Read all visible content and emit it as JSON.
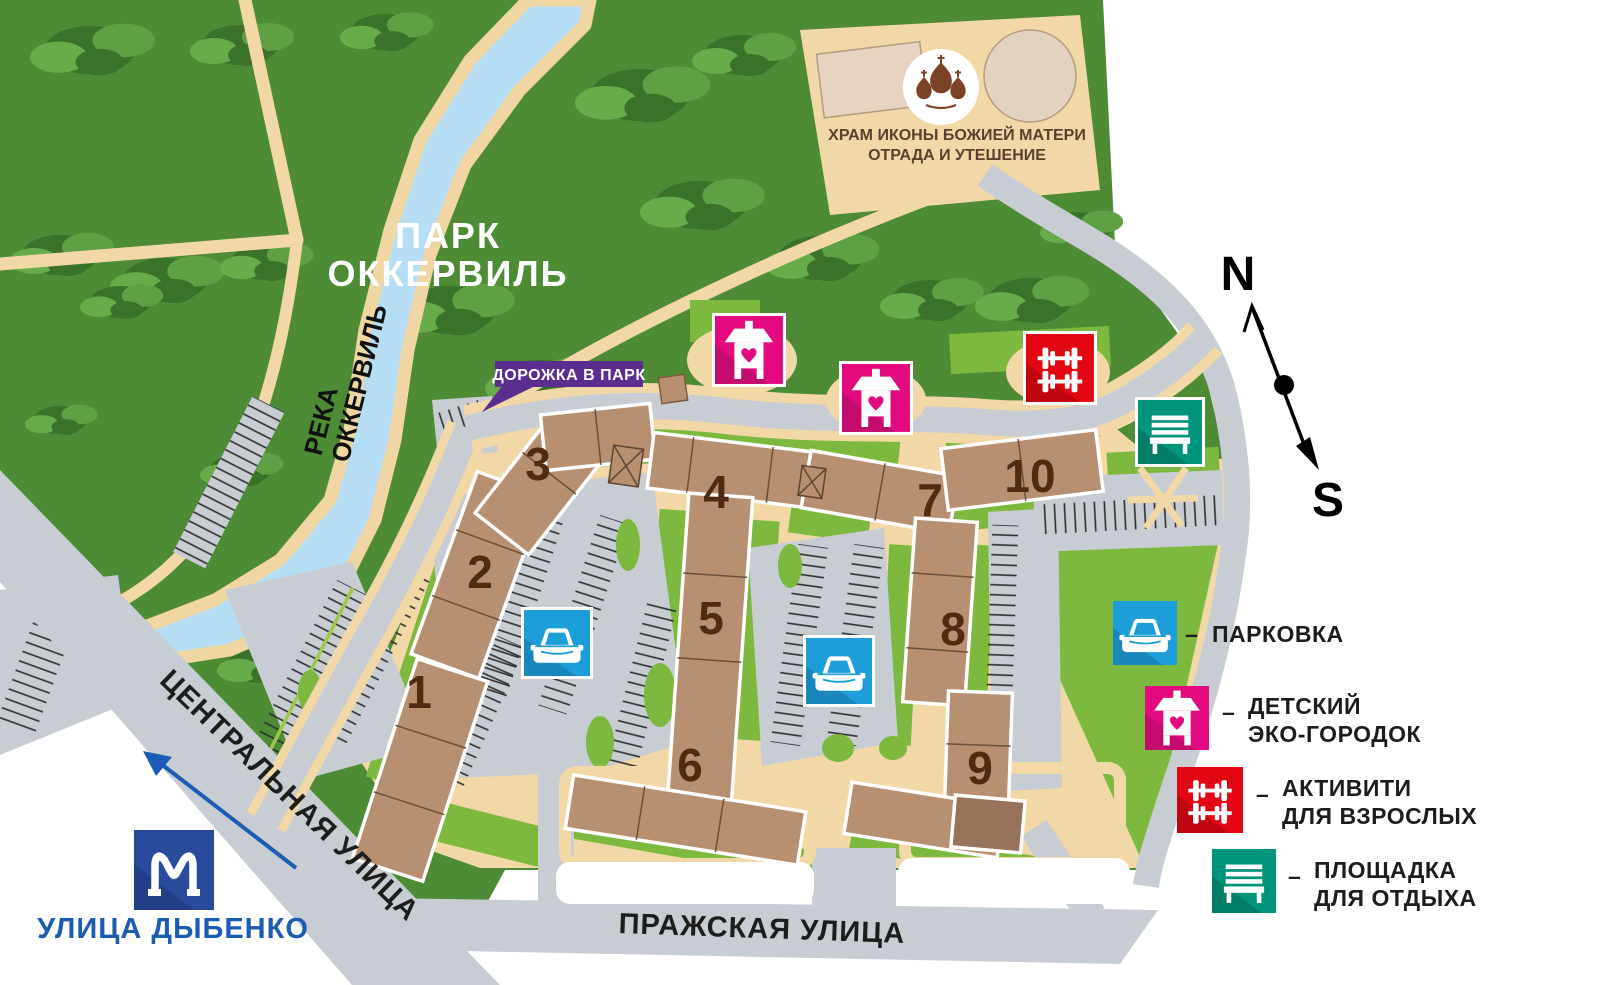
{
  "map": {
    "park_label": {
      "line1": "ПАРК",
      "line2": "ОККЕРВИЛЬ"
    },
    "river_label": {
      "line1": "РЕКА",
      "line2": "ОККЕРВИЛЬ"
    },
    "church_label": {
      "line1": "ХРАМ ИКОНЫ БОЖИЕЙ МАТЕРИ",
      "line2": "ОТРАДА И УТЕШЕНИЕ"
    },
    "path_to_park_badge": "ДОРОЖКА В ПАРК",
    "streets": {
      "central": "ЦЕНТРАЛЬНАЯ УЛИЦА",
      "prazhskaya": "ПРАЖСКАЯ УЛИЦА"
    },
    "metro_station": "УЛИЦА ДЫБЕНКО",
    "compass": {
      "north": "N",
      "south": "S"
    },
    "building_numbers": [
      "1",
      "2",
      "3",
      "4",
      "5",
      "6",
      "7",
      "8",
      "9",
      "10"
    ]
  },
  "legend": {
    "separator": "–",
    "items": [
      {
        "id": "parking",
        "icon": "parking-icon",
        "color": "#1d9ed9",
        "line1": "ПАРКОВКА",
        "line2": ""
      },
      {
        "id": "kids-eco-town",
        "icon": "kids-playhouse-icon",
        "color": "#e20a7e",
        "line1": "ДЕТСКИЙ",
        "line2": "ЭКО-ГОРОДОК"
      },
      {
        "id": "adult-activity",
        "icon": "dumbbell-icon",
        "color": "#e30613",
        "line1": "АКТИВИТИ",
        "line2": "ДЛЯ ВЗРОСЛЫХ"
      },
      {
        "id": "rest-area",
        "icon": "bench-icon",
        "color": "#00957a",
        "line1": "ПЛОЩАДКА",
        "line2": "ДЛЯ ОТДЫХА"
      }
    ]
  },
  "colors": {
    "park_green": "#4e8b35",
    "lawn_green": "#7cb93e",
    "river_blue": "#b5def4",
    "path_tan": "#f2d8a6",
    "road_gray": "#c7cdd3",
    "building_tan": "#b69070",
    "building_dark": "#96735a",
    "number_brown": "#4f2b12",
    "badge_purple": "#5b2d8f",
    "metro_blue": "#2a4b9b",
    "metro_label_blue": "#1b5db2",
    "icon_pink": "#e20a7e",
    "icon_red": "#e30613",
    "icon_blue": "#1d9ed9",
    "icon_teal": "#00957a",
    "church_brown": "#7a4226"
  }
}
